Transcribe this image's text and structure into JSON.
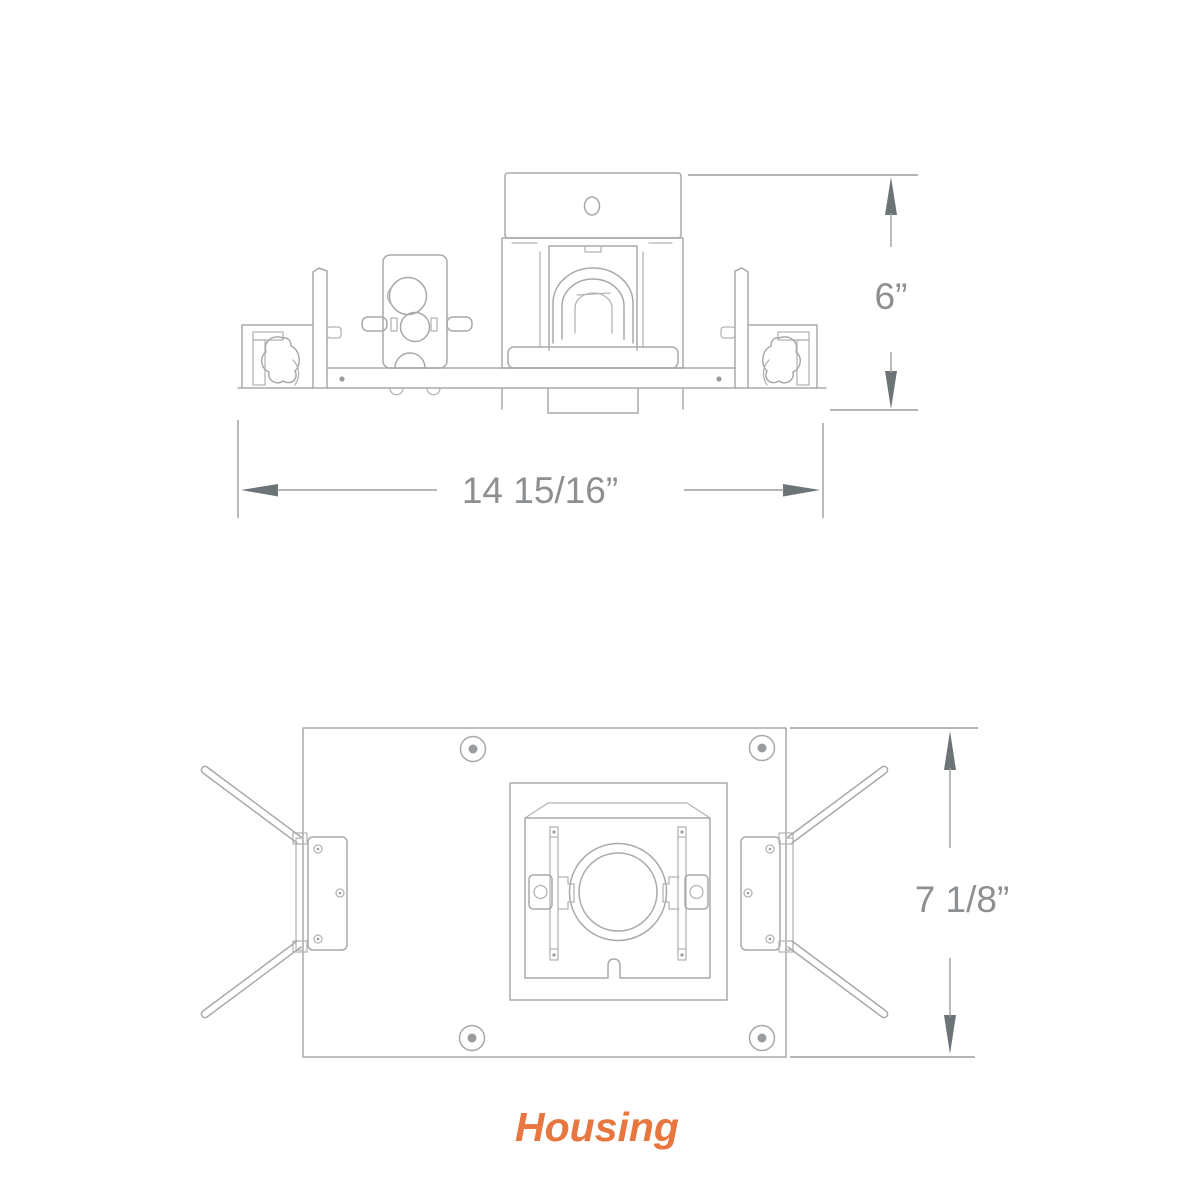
{
  "drawing": {
    "caption": "Housing",
    "views": [
      {
        "id": "front-elevation",
        "dimensions": [
          {
            "axis": "height",
            "label": "6”"
          },
          {
            "axis": "width",
            "label": "14 15/16”"
          }
        ]
      },
      {
        "id": "plan-view",
        "dimensions": [
          {
            "axis": "height",
            "label": "7 1/8”"
          }
        ]
      }
    ]
  },
  "colors": {
    "background": "#ffffff",
    "line": "#a8aaa9",
    "dimension_line": "#9a9da0",
    "arrowhead": "#6d7478",
    "dimension_text": "#8d9093",
    "accent": "#e8763f"
  }
}
